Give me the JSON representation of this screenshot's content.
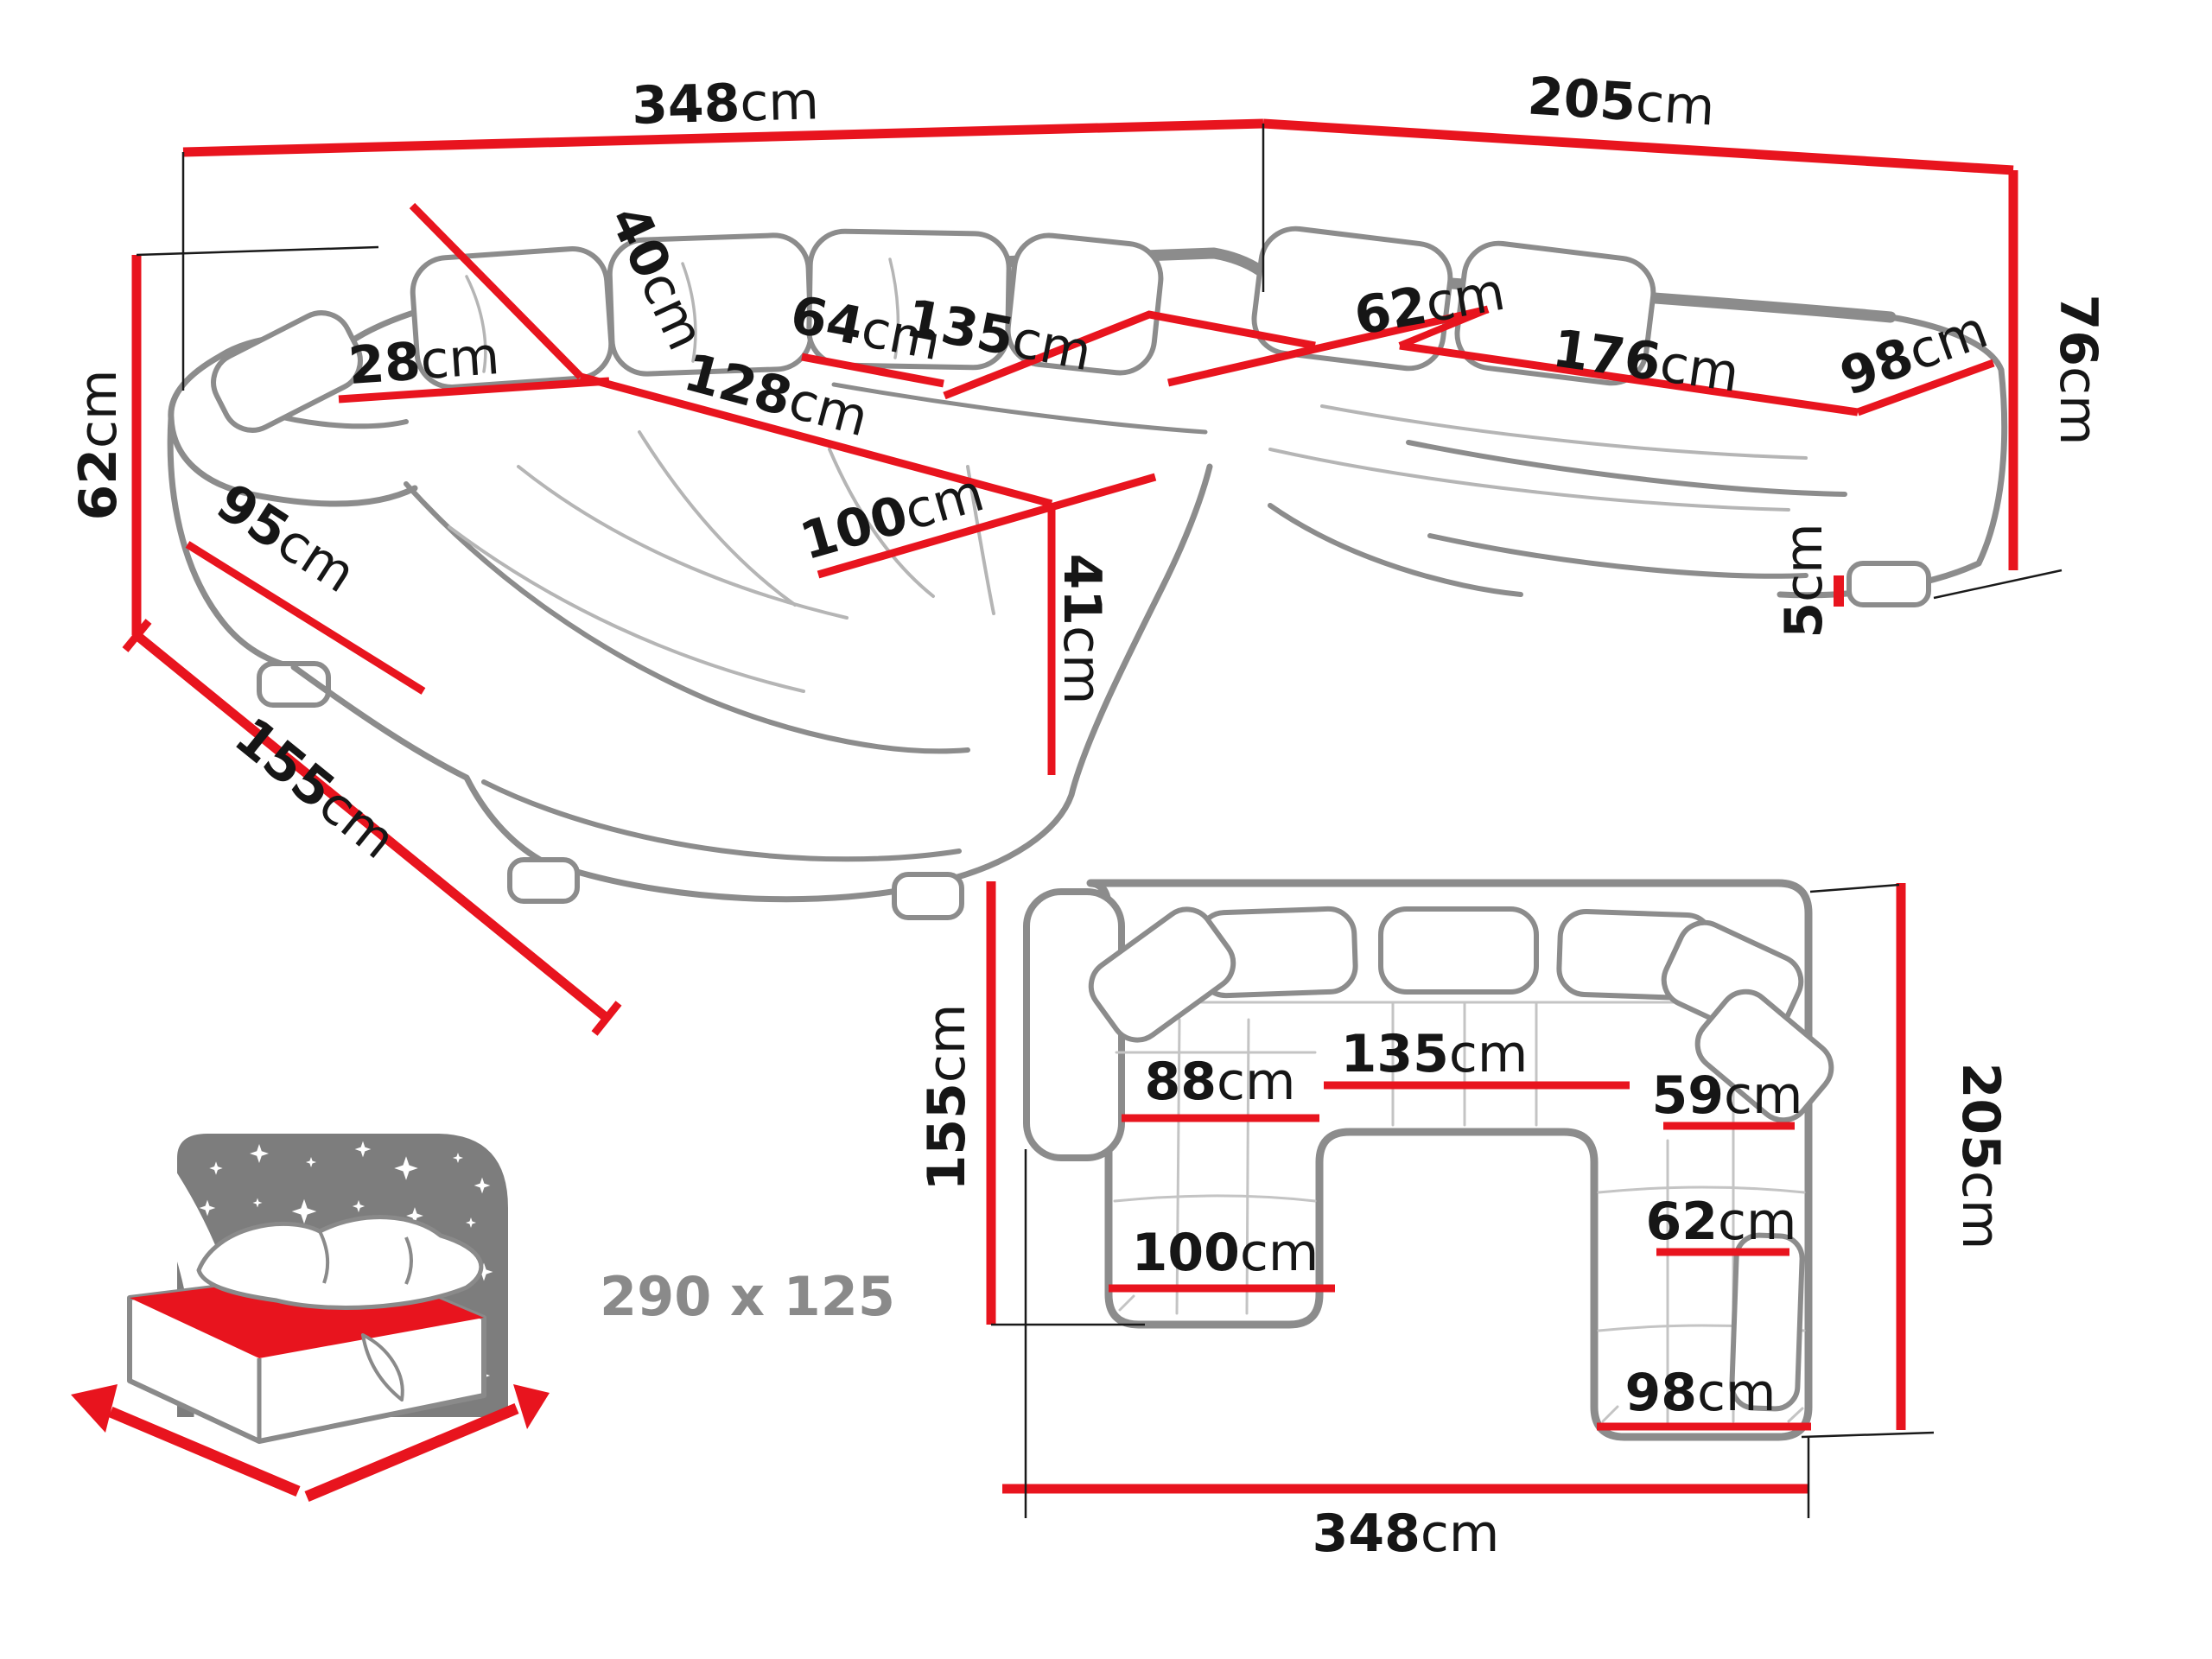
{
  "background": "#ffffff",
  "colors": {
    "dimension_red": "#e8141e",
    "outline_gray": "#8c8c8c",
    "label_black": "#161616",
    "muted_gray": "#8a8a8a"
  },
  "perspective_view": {
    "back_width": {
      "value": "348",
      "unit": "cm"
    },
    "right_width": {
      "value": "205",
      "unit": "cm"
    },
    "back_height": {
      "value": "76",
      "unit": "cm"
    },
    "arm_height": {
      "value": "62",
      "unit": "cm"
    },
    "chaise_total_length": {
      "value": "155",
      "unit": "cm"
    },
    "arm_front_length": {
      "value": "95",
      "unit": "cm"
    },
    "armrest_width": {
      "value": "28",
      "unit": "cm"
    },
    "back_cushion_height": {
      "value": "40",
      "unit": "cm"
    },
    "back_seat_depth": {
      "value": "64",
      "unit": "cm"
    },
    "middle_seat_width": {
      "value": "135",
      "unit": "cm"
    },
    "chaise_inner_length": {
      "value": "128",
      "unit": "cm"
    },
    "right_seat_depth": {
      "value": "62",
      "unit": "cm"
    },
    "right_seat_length": {
      "value": "176",
      "unit": "cm"
    },
    "right_end_width": {
      "value": "98",
      "unit": "cm"
    },
    "chaise_width": {
      "value": "100",
      "unit": "cm"
    },
    "seat_height": {
      "value": "41",
      "unit": "cm"
    },
    "leg_height": {
      "value": "5",
      "unit": "cm"
    }
  },
  "plan_view": {
    "chaise_depth": {
      "value": "155",
      "unit": "cm"
    },
    "chaise_seat_width": {
      "value": "88",
      "unit": "cm"
    },
    "middle_seat_width": {
      "value": "135",
      "unit": "cm"
    },
    "right_seat_width_upper": {
      "value": "59",
      "unit": "cm"
    },
    "right_side_depth": {
      "value": "205",
      "unit": "cm"
    },
    "right_seat_width": {
      "value": "62",
      "unit": "cm"
    },
    "right_end_width": {
      "value": "98",
      "unit": "cm"
    },
    "chaise_width": {
      "value": "100",
      "unit": "cm"
    },
    "total_width": {
      "value": "348",
      "unit": "cm"
    }
  },
  "sleeping_area": {
    "dimensions": "290 x 125"
  }
}
